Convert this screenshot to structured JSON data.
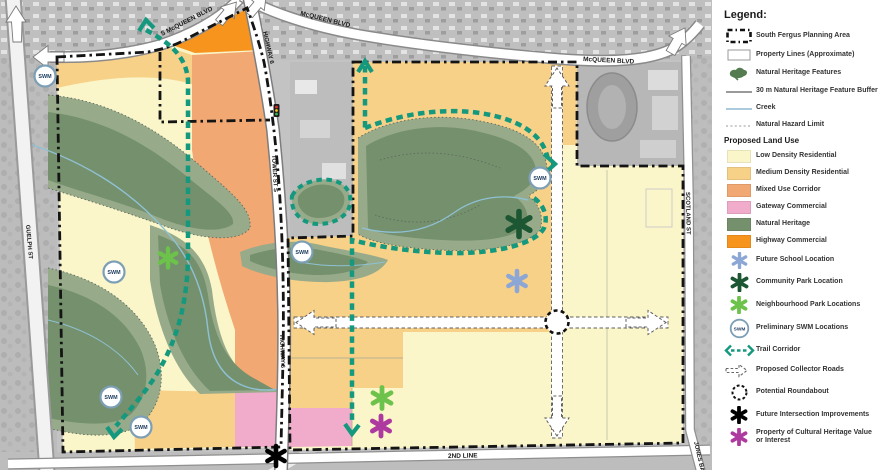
{
  "map": {
    "road_labels": {
      "s_mcqueen_blvd": "S McQUEEN BLVD",
      "mcqueen_blvd_top": "McQUEEN BLVD",
      "mcqueen_blvd_east": "McQUEEN BLVD",
      "highway_6_north": "HIGHWAY 6",
      "tower_st_s": "TOWER ST S",
      "highway_6_south": "HIGHWAY 6",
      "guelph_st": "GUELPH ST",
      "scotland_st": "SCOTLAND ST",
      "second_line": "2ND LINE",
      "jones_baseline": "JONES BASELINE"
    },
    "swm_label": "SWM"
  },
  "legend": {
    "title": "Legend:",
    "features": [
      {
        "label": "South Fergus Planning Area",
        "icon": "planning-area-boundary"
      },
      {
        "label": "Property Lines (Approximate)",
        "icon": "property-lines"
      },
      {
        "label": "Natural Heritage Features",
        "icon": "natural-heritage-blob"
      },
      {
        "label": "30 m Natural Heritage Feature Buffer",
        "icon": "buffer-line"
      },
      {
        "label": "Creek",
        "icon": "creek-line"
      },
      {
        "label": "Natural Hazard Limit",
        "icon": "hazard-limit-line"
      }
    ],
    "landuse_header": "Proposed Land Use",
    "landuse": [
      {
        "label": "Low Density Residential",
        "color": "#FAF6C9"
      },
      {
        "label": "Medium Density Residential",
        "color": "#F8D189"
      },
      {
        "label": "Mixed Use Corridor",
        "color": "#F2A873"
      },
      {
        "label": "Gateway Commercial",
        "color": "#F1ABCB"
      },
      {
        "label": "Natural Heritage",
        "color": "#75906C"
      },
      {
        "label": "Highway Commercial",
        "color": "#F7941E"
      }
    ],
    "symbols": [
      {
        "label": "Future School Location",
        "color": "#8CA6D5"
      },
      {
        "label": "Community Park Location",
        "color": "#1C5632"
      },
      {
        "label": "Neighbourhood Park Locations",
        "color": "#6CC24A"
      },
      {
        "label": "Preliminary SWM Locations",
        "color": "#7C9FB6"
      },
      {
        "label": "Trail Corridor",
        "color": "#14997E"
      },
      {
        "label": "Proposed Collector Roads",
        "color": "#666666"
      },
      {
        "label": "Potential Roundabout",
        "color": "#111111"
      },
      {
        "label": "Future Intersection Improvements",
        "color": "#000000"
      },
      {
        "label": "Property of Cultural Heritage Value or Interest",
        "color": "#AE3AA0"
      }
    ]
  }
}
